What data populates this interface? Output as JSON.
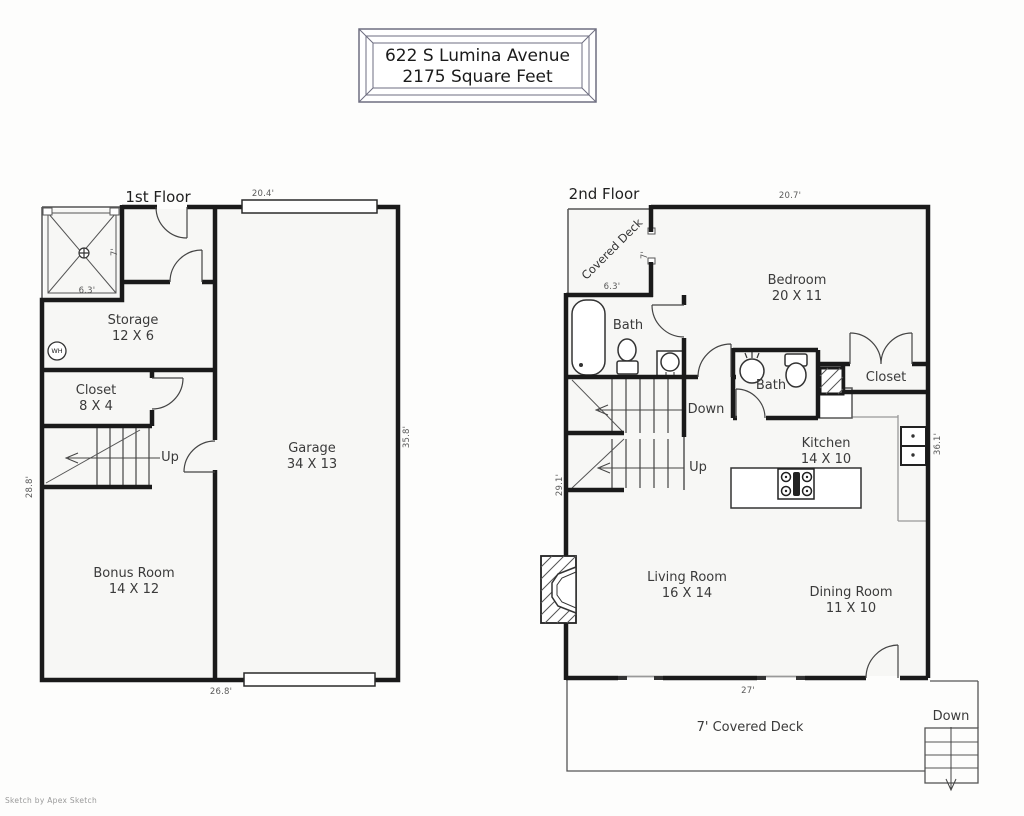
{
  "title": {
    "line1": "622 S Lumina Avenue",
    "line2": "2175 Square Feet"
  },
  "credit": "Sketch by Apex Sketch",
  "floor1": {
    "label": "1st Floor",
    "rooms": {
      "storage": {
        "name": "Storage",
        "dims": "12 X 6"
      },
      "closet": {
        "name": "Closet",
        "dims": "8 X 4"
      },
      "garage": {
        "name": "Garage",
        "dims": "34 X 13"
      },
      "bonus": {
        "name": "Bonus Room",
        "dims": "14 X 12"
      }
    },
    "stairs_up": "Up",
    "water_heater": "WH",
    "dims": {
      "top": "20.4'",
      "bottom": "26.8'",
      "left": "28.8'",
      "right": "35.8'",
      "deck_width": "6.3'",
      "deck_depth": "7'"
    }
  },
  "floor2": {
    "label": "2nd Floor",
    "rooms": {
      "covered_deck": {
        "name": "Covered Deck"
      },
      "bedroom": {
        "name": "Bedroom",
        "dims": "20 X 11"
      },
      "bath_main": {
        "name": "Bath"
      },
      "bath_half": {
        "name": "Bath"
      },
      "closet": {
        "name": "Closet"
      },
      "kitchen": {
        "name": "Kitchen",
        "dims": "14 X 10"
      },
      "living": {
        "name": "Living Room",
        "dims": "16 X 14"
      },
      "dining": {
        "name": "Dining Room",
        "dims": "11 X 10"
      },
      "deck": {
        "name": "7' Covered Deck"
      }
    },
    "stairs_down": "Down",
    "stairs_up": "Up",
    "deck_stairs_down": "Down",
    "dims": {
      "top": "20.7'",
      "right": "36.1'",
      "left": "29.1'",
      "wall": "27'",
      "deck_width": "6.3'",
      "deck_depth": "7'"
    }
  }
}
